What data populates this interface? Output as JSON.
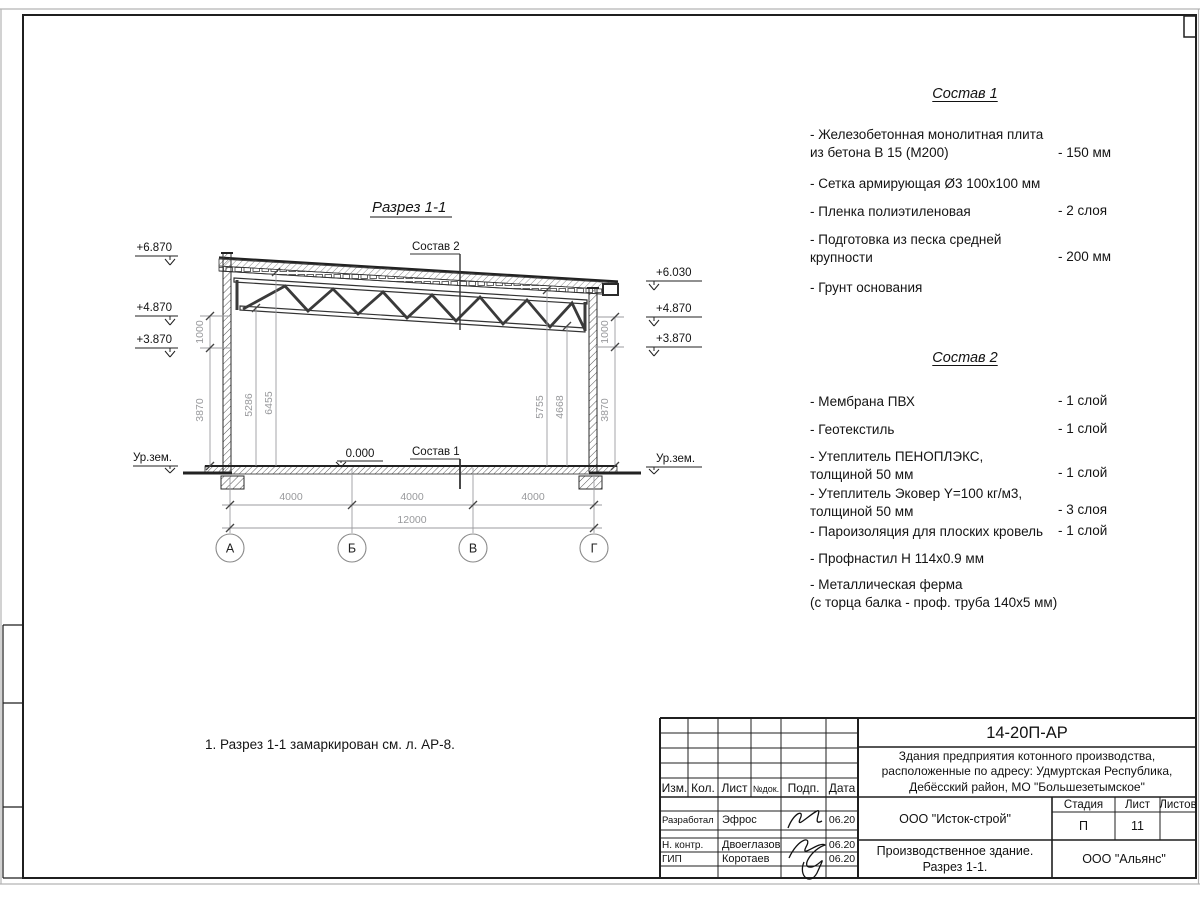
{
  "sheet": {
    "title": "Разрез 1-1",
    "note": "1. Разрез 1-1 замаркирован см. л. АР-8.",
    "labels": {
      "sostav1": "Состав 1",
      "sostav2": "Состав 2",
      "zero": "0.000",
      "ground": "Ур.зем."
    },
    "elev": {
      "l1": "+6.870",
      "l2": "+4.870",
      "l3": "+3.870",
      "r1": "+6.030",
      "r2": "+4.870",
      "r3": "+3.870"
    },
    "dims": {
      "k1000": "1000",
      "k3870": "3870",
      "h5286": "5286",
      "h6455": "6455",
      "h5755": "5755",
      "h4668": "4668",
      "span": "4000",
      "total": "12000"
    },
    "axes": [
      "А",
      "Б",
      "В",
      "Г"
    ]
  },
  "spec1": {
    "title": "Состав 1",
    "items": [
      {
        "text": "- Железобетонная  монолитная плита\n  из бетона В 15 (М200)",
        "value": "- 150 мм"
      },
      {
        "text": "- Сетка армирующая Ø3 100х100 мм",
        "value": ""
      },
      {
        "text": "- Пленка полиэтиленовая",
        "value": "-  2 слоя"
      },
      {
        "text": "- Подготовка из песка средней\n  крупности",
        "value": "- 200 мм"
      },
      {
        "text": "- Грунт основания",
        "value": ""
      }
    ]
  },
  "spec2": {
    "title": "Состав 2",
    "items": [
      {
        "text": "- Мембрана ПВХ",
        "value": "- 1 слой"
      },
      {
        "text": "- Геотекстиль",
        "value": "- 1 слой"
      },
      {
        "text": "- Утеплитель ПЕНОПЛЭКС,\n  толщиной 50 мм",
        "value": "- 1 слой"
      },
      {
        "text": "- Утеплитель Эковер Y=100 кг/м3,\n  толщиной 50 мм",
        "value": "- 3 слоя"
      },
      {
        "text": "- Пароизоляция для плоских кровель",
        "value": "- 1 слой"
      },
      {
        "text": "- Профнастил Н 114х0.9 мм",
        "value": ""
      },
      {
        "text": "- Металлическая ферма\n  (с торца балка - проф. труба 140х5 мм)",
        "value": ""
      }
    ]
  },
  "tb": {
    "doc": "14-20П-АР",
    "project": "Здания предприятия котонного производства,\nрасположенные по адресу: Удмуртская Республика,\nДебёсский район, МО \"Большезетымское\"",
    "cols": [
      "Изм.",
      "Кол.",
      "Лист",
      "№док.",
      "Подп.",
      "Дата"
    ],
    "rows": [
      {
        "role": "Разработал",
        "name": "Эфрос",
        "date": "06.20"
      },
      {
        "role": "Н. контр.",
        "name": "Двоеглазов",
        "date": "06.20"
      },
      {
        "role": "ГИП",
        "name": "Коротаев",
        "date": "06.20"
      }
    ],
    "org1": "ООО \"Исток-строй\"",
    "stage_label": "Стадия",
    "sheet_label": "Лист",
    "sheets_label": "Листов",
    "stage": "П",
    "sheet_no": "11",
    "object": "Производственное здание.\nРазрез 1-1.",
    "org2": "ООО \"Альянс\""
  }
}
